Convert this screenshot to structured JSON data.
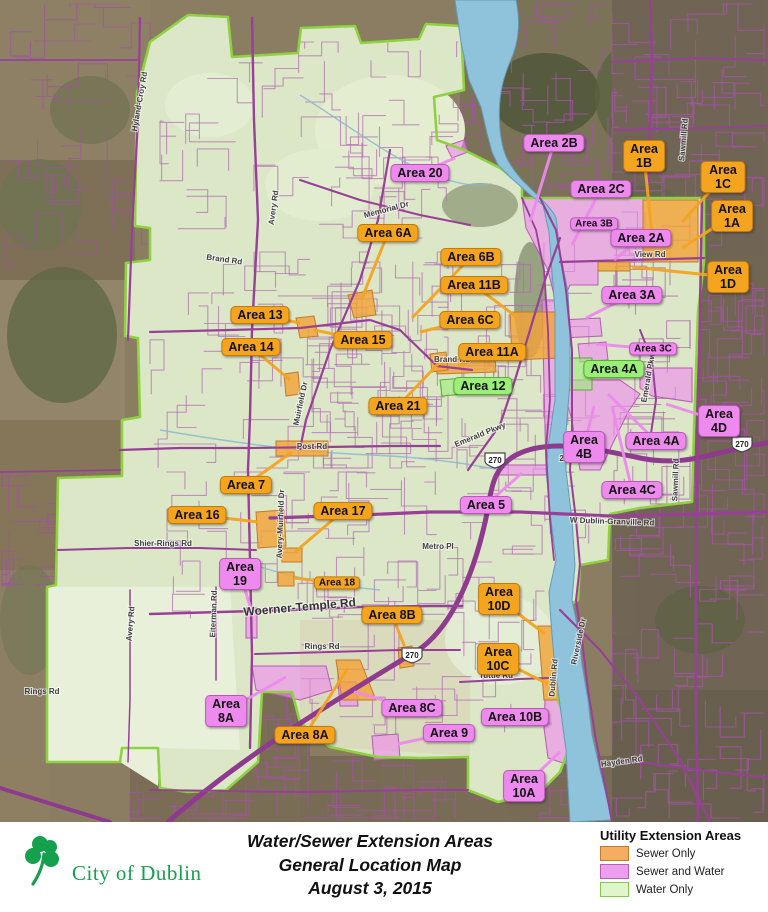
{
  "footer": {
    "title_line1": "Water/Sewer Extension Areas",
    "title_line2": "General Location Map",
    "title_line3": "August 3, 2015",
    "logo_text": "City of Dublin",
    "logo_color": "#14A04C"
  },
  "legend": {
    "title": "Utility Extension Areas",
    "items": [
      {
        "label": "Sewer Only",
        "fill": "#F5AD61",
        "border": "#C07A2D"
      },
      {
        "label": "Sewer and Water",
        "fill": "#EE9EEE",
        "border": "#B361B3"
      },
      {
        "label": "Water Only",
        "fill": "#DFF5CB",
        "border": "#85C74F"
      }
    ]
  },
  "map": {
    "highway_shield": "270",
    "label_colors": {
      "sewer": "#F4A41F",
      "both": "#EE8AEE",
      "water": "#9BEE78"
    },
    "area_labels": [
      {
        "id": "20",
        "lines": [
          "Area 20"
        ],
        "type": "both",
        "x": 420,
        "y": 173,
        "lx": 455,
        "ly": 158
      },
      {
        "id": "2B",
        "lines": [
          "Area 2B"
        ],
        "type": "both",
        "x": 554,
        "y": 143,
        "lx": 530,
        "ly": 222
      },
      {
        "id": "1B",
        "lines": [
          "Area",
          "1B"
        ],
        "type": "sewer",
        "x": 644,
        "y": 156,
        "lx": 652,
        "ly": 235
      },
      {
        "id": "2C",
        "lines": [
          "Area 2C"
        ],
        "type": "both",
        "x": 601,
        "y": 189,
        "lx": 572,
        "ly": 245
      },
      {
        "id": "1C",
        "lines": [
          "Area 1C"
        ],
        "type": "sewer",
        "x": 723,
        "y": 177,
        "lx": 682,
        "ly": 222
      },
      {
        "id": "3B",
        "lines": [
          "Area 3B"
        ],
        "type": "both",
        "small": true,
        "x": 594,
        "y": 224
      },
      {
        "id": "2A",
        "lines": [
          "Area 2A"
        ],
        "type": "both",
        "x": 641,
        "y": 238,
        "lx": 614,
        "ly": 260
      },
      {
        "id": "1A",
        "lines": [
          "Area 1A"
        ],
        "type": "sewer",
        "x": 732,
        "y": 216,
        "lx": 682,
        "ly": 248
      },
      {
        "id": "1D",
        "lines": [
          "Area 1D"
        ],
        "type": "sewer",
        "x": 728,
        "y": 277,
        "lx": 632,
        "ly": 267
      },
      {
        "id": "3A",
        "lines": [
          "Area 3A"
        ],
        "type": "both",
        "x": 632,
        "y": 295,
        "lx": 586,
        "ly": 318
      },
      {
        "id": "3C",
        "lines": [
          "Area 3C"
        ],
        "type": "both",
        "small": true,
        "x": 653,
        "y": 349,
        "lx": 596,
        "ly": 344
      },
      {
        "id": "4A-water",
        "lines": [
          "Area 4A"
        ],
        "type": "water",
        "x": 614,
        "y": 369,
        "lx": 585,
        "ly": 380
      },
      {
        "id": "4D",
        "lines": [
          "Area",
          "4D"
        ],
        "type": "both",
        "x": 719,
        "y": 421,
        "lx": 666,
        "ly": 404
      },
      {
        "id": "4B",
        "lines": [
          "Area",
          "4B"
        ],
        "type": "both",
        "x": 584,
        "y": 447,
        "lx": 594,
        "ly": 406
      },
      {
        "id": "4A-sewer",
        "lines": [
          "Area 4A"
        ],
        "type": "both",
        "x": 656,
        "y": 441,
        "lx": 608,
        "ly": 394
      },
      {
        "id": "4C",
        "lines": [
          "Area 4C"
        ],
        "type": "both",
        "x": 632,
        "y": 490,
        "lx": 612,
        "ly": 406
      },
      {
        "id": "6A",
        "lines": [
          "Area 6A"
        ],
        "type": "sewer",
        "x": 388,
        "y": 233,
        "lx": 362,
        "ly": 298
      },
      {
        "id": "6B",
        "lines": [
          "Area 6B"
        ],
        "type": "sewer",
        "x": 471,
        "y": 257,
        "lx": 412,
        "ly": 318
      },
      {
        "id": "11B",
        "lines": [
          "Area 11B"
        ],
        "type": "sewer",
        "x": 474,
        "y": 285,
        "lx": 518,
        "ly": 318
      },
      {
        "id": "6C",
        "lines": [
          "Area 6C"
        ],
        "type": "sewer",
        "x": 470,
        "y": 320,
        "lx": 420,
        "ly": 332
      },
      {
        "id": "13",
        "lines": [
          "Area 13"
        ],
        "type": "sewer",
        "x": 260,
        "y": 315,
        "lx": 300,
        "ly": 323
      },
      {
        "id": "14",
        "lines": [
          "Area 14"
        ],
        "type": "sewer",
        "x": 251,
        "y": 347,
        "lx": 290,
        "ly": 380
      },
      {
        "id": "15",
        "lines": [
          "Area 15"
        ],
        "type": "sewer",
        "x": 363,
        "y": 340,
        "lx": 314,
        "ly": 330
      },
      {
        "id": "11A",
        "lines": [
          "Area 11A"
        ],
        "type": "sewer",
        "x": 492,
        "y": 352,
        "lx": 458,
        "ly": 366
      },
      {
        "id": "12",
        "lines": [
          "Area 12"
        ],
        "type": "water",
        "x": 483,
        "y": 386,
        "lx": 456,
        "ly": 388
      },
      {
        "id": "21",
        "lines": [
          "Area 21"
        ],
        "type": "sewer",
        "x": 398,
        "y": 406,
        "lx": 438,
        "ly": 364
      },
      {
        "id": "7",
        "lines": [
          "Area 7"
        ],
        "type": "sewer",
        "x": 246,
        "y": 485,
        "lx": 292,
        "ly": 452
      },
      {
        "id": "16",
        "lines": [
          "Area 16"
        ],
        "type": "sewer",
        "x": 197,
        "y": 515,
        "lx": 258,
        "ly": 522
      },
      {
        "id": "17",
        "lines": [
          "Area 17"
        ],
        "type": "sewer",
        "x": 343,
        "y": 511,
        "lx": 295,
        "ly": 552
      },
      {
        "id": "5",
        "lines": [
          "Area 5"
        ],
        "type": "both",
        "x": 486,
        "y": 505,
        "lx": 522,
        "ly": 473
      },
      {
        "id": "19",
        "lines": [
          "Area",
          "19"
        ],
        "type": "both",
        "x": 240,
        "y": 574,
        "lx": 252,
        "ly": 612
      },
      {
        "id": "18",
        "lines": [
          "Area 18"
        ],
        "type": "sewer",
        "small": true,
        "x": 337,
        "y": 583,
        "lx": 294,
        "ly": 578
      },
      {
        "id": "8B",
        "lines": [
          "Area 8B"
        ],
        "type": "sewer",
        "x": 392,
        "y": 615,
        "lx": 406,
        "ly": 650
      },
      {
        "id": "10D",
        "lines": [
          "Area",
          "10D"
        ],
        "type": "sewer",
        "x": 499,
        "y": 599,
        "lx": 545,
        "ly": 634
      },
      {
        "id": "10C",
        "lines": [
          "Area",
          "10C"
        ],
        "type": "sewer",
        "x": 498,
        "y": 659,
        "lx": 550,
        "ly": 685
      },
      {
        "id": "8A-sewer-water",
        "lines": [
          "Area",
          "8A"
        ],
        "type": "both",
        "x": 226,
        "y": 711,
        "lx": 286,
        "ly": 677
      },
      {
        "id": "8A-sewer",
        "lines": [
          "Area 8A"
        ],
        "type": "sewer",
        "x": 305,
        "y": 735,
        "lx": 348,
        "ly": 668
      },
      {
        "id": "8C",
        "lines": [
          "Area 8C"
        ],
        "type": "both",
        "x": 412,
        "y": 708,
        "lx": 354,
        "ly": 692
      },
      {
        "id": "9",
        "lines": [
          "Area 9"
        ],
        "type": "both",
        "x": 449,
        "y": 733,
        "lx": 398,
        "ly": 744
      },
      {
        "id": "10B",
        "lines": [
          "Area 10B"
        ],
        "type": "both",
        "x": 515,
        "y": 717,
        "lx": 552,
        "ly": 724
      },
      {
        "id": "10A",
        "lines": [
          "Area",
          "10A"
        ],
        "type": "both",
        "x": 524,
        "y": 786,
        "lx": 560,
        "ly": 752
      }
    ],
    "road_labels": [
      {
        "text": "Memorial Dr",
        "x": 387,
        "y": 212,
        "r": -15
      },
      {
        "text": "Muirfield Dr",
        "x": 303,
        "y": 404,
        "r": -78
      },
      {
        "text": "Brand Rd",
        "x": 452,
        "y": 362,
        "r": 0
      },
      {
        "text": "Brand Rd",
        "x": 224,
        "y": 262,
        "r": 8
      },
      {
        "text": "Post Rd",
        "x": 312,
        "y": 449,
        "r": 0
      },
      {
        "text": "Avery-Muirfield Dr",
        "x": 283,
        "y": 524,
        "r": -88
      },
      {
        "text": "Woerner-Temple Rd",
        "x": 300,
        "y": 611,
        "r": -5,
        "big": true
      },
      {
        "text": "Rings Rd",
        "x": 322,
        "y": 649,
        "r": 0
      },
      {
        "text": "Rings Rd",
        "x": 42,
        "y": 694,
        "r": 0
      },
      {
        "text": "Tuttle Rd",
        "x": 496,
        "y": 678,
        "r": 0
      },
      {
        "text": "Emerald Pkwy",
        "x": 481,
        "y": 437,
        "r": -22
      },
      {
        "text": "Emerald Pkwy",
        "x": 651,
        "y": 376,
        "r": -80
      },
      {
        "text": "Riverside Dr",
        "x": 581,
        "y": 642,
        "r": -78
      },
      {
        "text": "Sawmill Rd",
        "x": 678,
        "y": 480,
        "r": -88
      },
      {
        "text": "Sawmill Rd",
        "x": 686,
        "y": 140,
        "r": -85
      },
      {
        "text": "W Dublin-Granville Rd",
        "x": 612,
        "y": 524,
        "r": 2
      },
      {
        "text": "Hyland-Croy Rd",
        "x": 142,
        "y": 102,
        "r": -80
      },
      {
        "text": "Avery Rd",
        "x": 276,
        "y": 208,
        "r": -82
      },
      {
        "text": "Avery Rd",
        "x": 133,
        "y": 624,
        "r": -85
      },
      {
        "text": "Shier-Rings Rd",
        "x": 163,
        "y": 546,
        "r": 0
      },
      {
        "text": "Metro Pl",
        "x": 438,
        "y": 549,
        "r": 0
      },
      {
        "text": "Eiterman Rd",
        "x": 216,
        "y": 614,
        "r": -88
      },
      {
        "text": "Dublin Rd",
        "x": 556,
        "y": 678,
        "r": -85
      },
      {
        "text": "View Rd",
        "x": 650,
        "y": 257,
        "r": 0
      },
      {
        "text": "Hayden Rd",
        "x": 622,
        "y": 764,
        "r": -8
      },
      {
        "text": "257",
        "x": 566,
        "y": 461,
        "r": 0
      }
    ],
    "shields": [
      {
        "x": 495,
        "y": 460
      },
      {
        "x": 412,
        "y": 655
      },
      {
        "x": 742,
        "y": 444
      }
    ]
  }
}
